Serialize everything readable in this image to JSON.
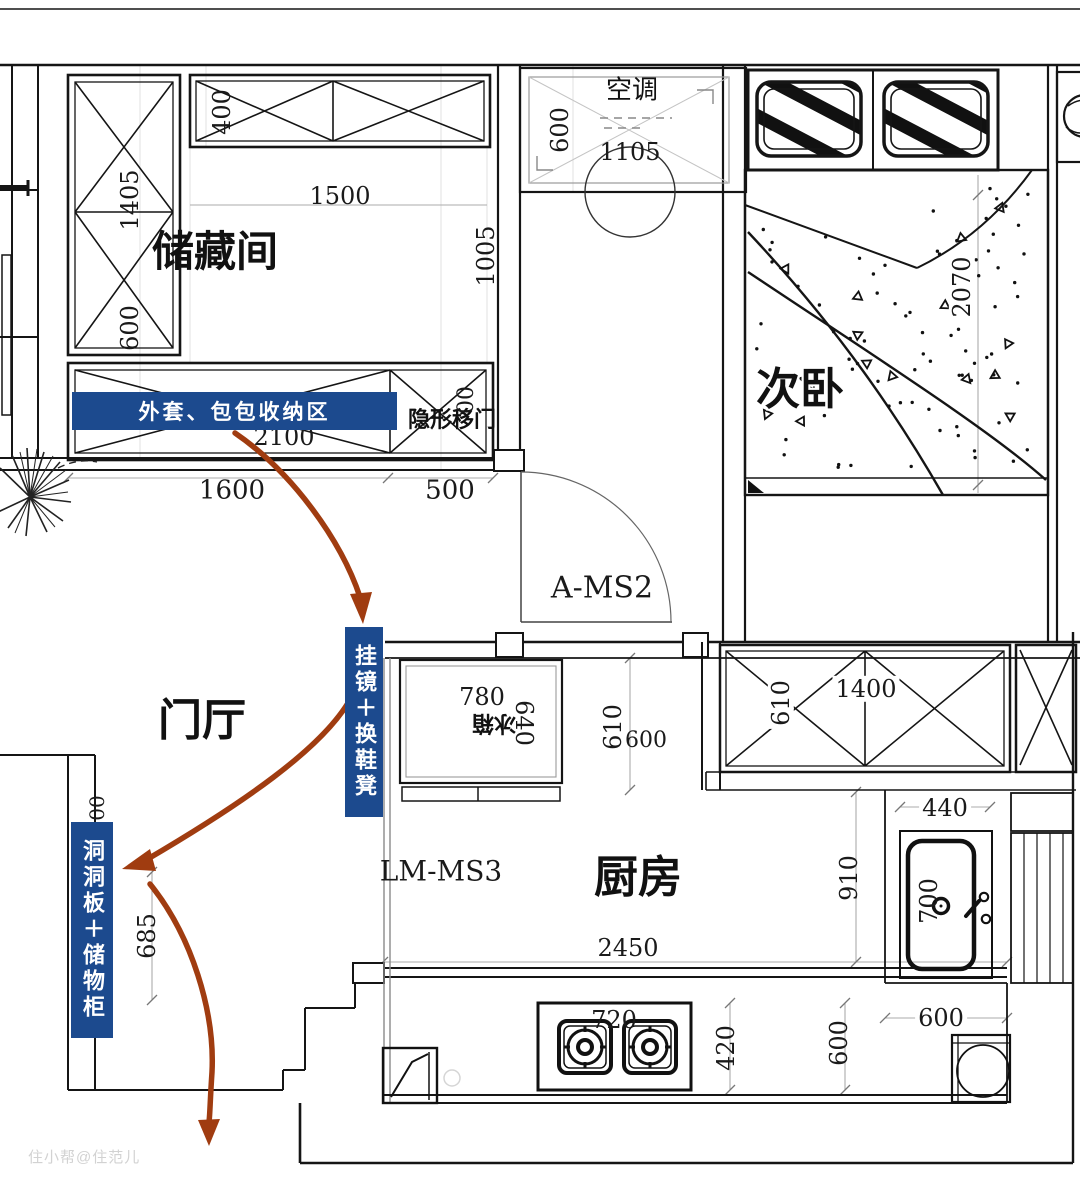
{
  "meta": {
    "type": "floor-plan",
    "language": "zh-CN"
  },
  "rooms": {
    "storage": "储藏间",
    "bedroom": "次卧",
    "hall": "门厅",
    "kitchen": "厨房"
  },
  "annotations": {
    "coat_banner": "外套、包包收纳区",
    "mirror_bench": "挂镜＋换鞋凳",
    "pegboard": "洞洞板＋储物柜",
    "hidden_door": "隐形移门",
    "ac": "空调",
    "fridge": "冰箱",
    "door_a": "A-MS2",
    "door_lm": "LM-MS3",
    "watermark": "住小帮@住范儿"
  },
  "dimensions": {
    "storage_top_depth": "400",
    "storage_cab_height": "1405",
    "storage_width": "1500",
    "storage_depth": "1005",
    "storage_cab_width": "600",
    "coat_cab_width": "2100",
    "coat_partial": "00",
    "storage_total": "1600",
    "door_gap": "500",
    "ac_depth": "600",
    "ac_width": "1105",
    "bed_length": "2070",
    "fridge_width": "780",
    "fridge_depth": "640",
    "gap_depth": "610",
    "gap_width": "600",
    "cab_depth": "610",
    "cab_width": "1400",
    "sink_width": "440",
    "counter_depth": "910",
    "sink_length": "700",
    "counter_length": "2450",
    "stove_width": "720",
    "stove_depth": "420",
    "stove_offset": "600",
    "sink_col_width": "600",
    "peg_partial": "00",
    "peg_height": "685"
  },
  "colors": {
    "banner": "#1c4a8e",
    "arrow": "#a03c10",
    "line": "#151515"
  }
}
